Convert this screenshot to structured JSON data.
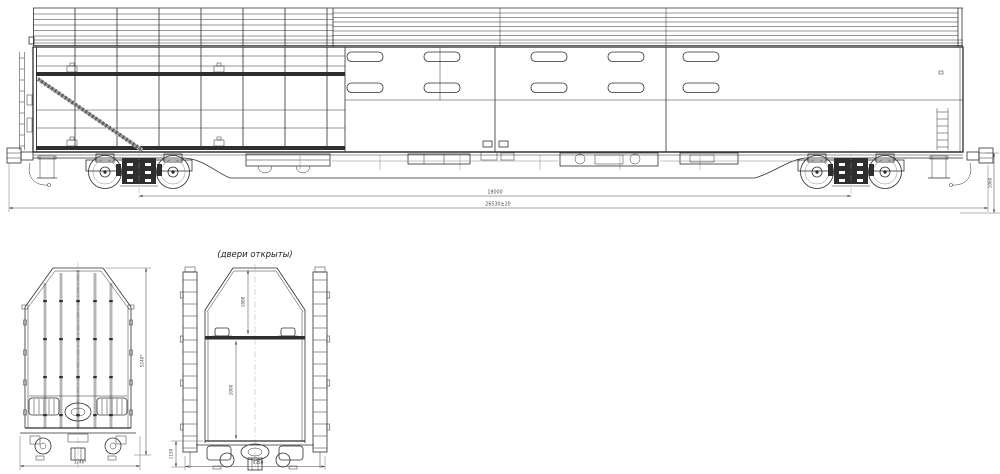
{
  "drawing": {
    "side_view": {
      "dim_bogie_centers": "19000",
      "dim_overall_length": "26530±20",
      "dim_coupler_height": "1060"
    },
    "end_view_closed": {
      "dim_width": "3246*",
      "dim_height": "5240*"
    },
    "end_view_open": {
      "label": "(двери открыты)",
      "dim_upper_tier": "1800",
      "dim_lower_tier": "2000",
      "dim_floor_height": "1150",
      "dim_width_open": "4350"
    },
    "colors": {
      "line": "#2e2e2e",
      "dim": "#4a4a4a",
      "background": "#ffffff"
    }
  }
}
